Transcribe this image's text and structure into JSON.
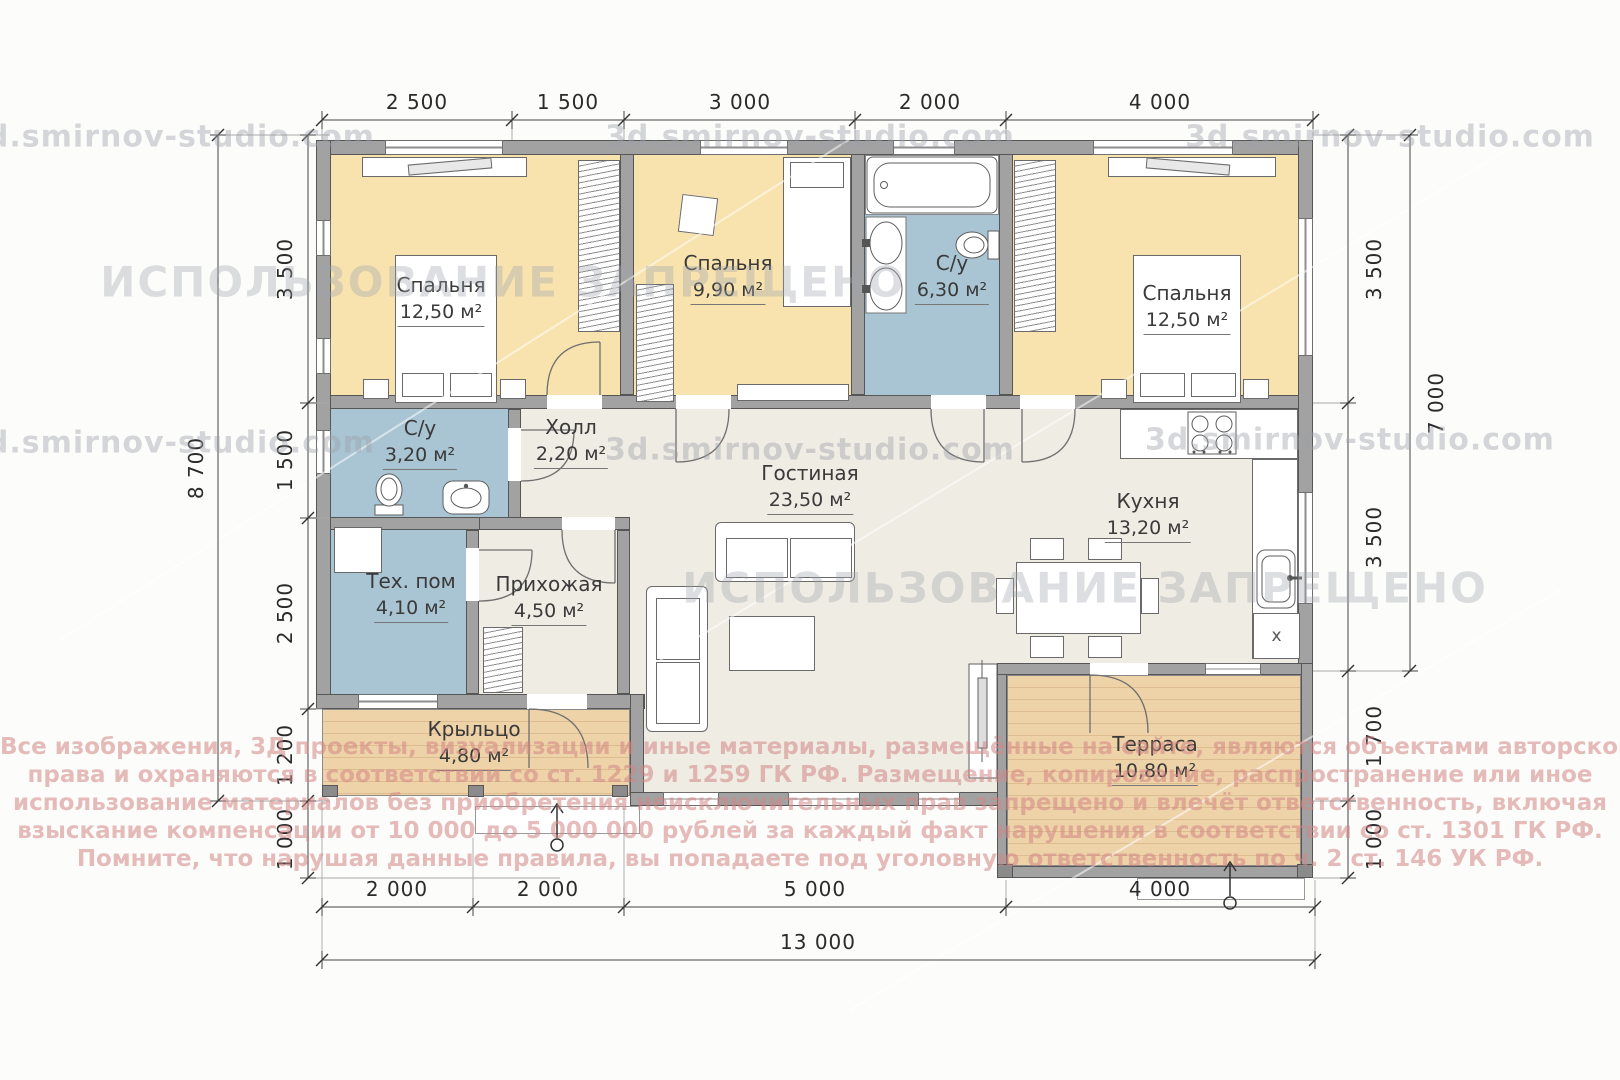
{
  "watermarks": {
    "site": "3d.smirnov-studio.com",
    "forbidden": "ИСПОЛЬЗОВАНИЕ ЗАПРЕЩЕНО"
  },
  "copyright": {
    "lines": [
      "Все изображения, 3Д проекты, визуализации и иные материалы, размещённые на сайте, являются объектами авторского",
      "права и охраняются в соответствии со ст. 1229 и 1259 ГК РФ. Размещение, копирование, распространение или иное",
      "использование материалов без приобретения неисключительных прав запрещено и влечёт ответственность, включая",
      "взыскание компенсации от 10 000 до 5 000 000 рублей за каждый факт нарушения в соответствии со ст. 1301 ГК РФ.",
      "Помните, что нарушая данные правила, вы попадаете под уголовную ответственность по ч. 2 ст. 146 УК РФ."
    ]
  },
  "rooms": {
    "bedroom1": {
      "name": "Спальня",
      "area": "12,50 м²"
    },
    "bedroom2": {
      "name": "Спальня",
      "area": "9,90 м²"
    },
    "bath_main": {
      "name": "С/у",
      "area": "6,30 м²"
    },
    "bedroom3": {
      "name": "Спальня",
      "area": "12,50 м²"
    },
    "bath_small": {
      "name": "С/у",
      "area": "3,20 м²"
    },
    "hall": {
      "name": "Холл",
      "area": "2,20 м²"
    },
    "living": {
      "name": "Гостиная",
      "area": "23,50 м²"
    },
    "kitchen": {
      "name": "Кухня",
      "area": "13,20 м²"
    },
    "tech": {
      "name": "Тех. пом",
      "area": "4,10 м²"
    },
    "entry": {
      "name": "Прихожая",
      "area": "4,50 м²"
    },
    "porch": {
      "name": "Крыльцо",
      "area": "4,80 м²"
    },
    "terrace": {
      "name": "Терраса",
      "area": "10,80 м²"
    }
  },
  "dimensions": {
    "top": [
      "2 500",
      "1 500",
      "3 000",
      "2 000",
      "4 000"
    ],
    "bottom": [
      "2 000",
      "2 000",
      "5 000",
      "4 000"
    ],
    "bottom_total": "13 000",
    "left": [
      "3 500",
      "1 500",
      "2 500",
      "1 200",
      "1 000"
    ],
    "left_total": "8 700",
    "right": [
      "3 500",
      "3 500",
      "1 700",
      "1 000"
    ],
    "right_total": "7 000"
  },
  "plan_symbols": {
    "washer": "х"
  },
  "colors": {
    "bedroom_fill": "#f8e3ae",
    "wet_fill": "#a9c4d3",
    "floor_fill": "#efece3",
    "wood_fill": "#eed2a8",
    "wall_fill": "#a2a2a2",
    "copyright_color": "#d08585",
    "watermark_color": "#9ba0a8"
  }
}
